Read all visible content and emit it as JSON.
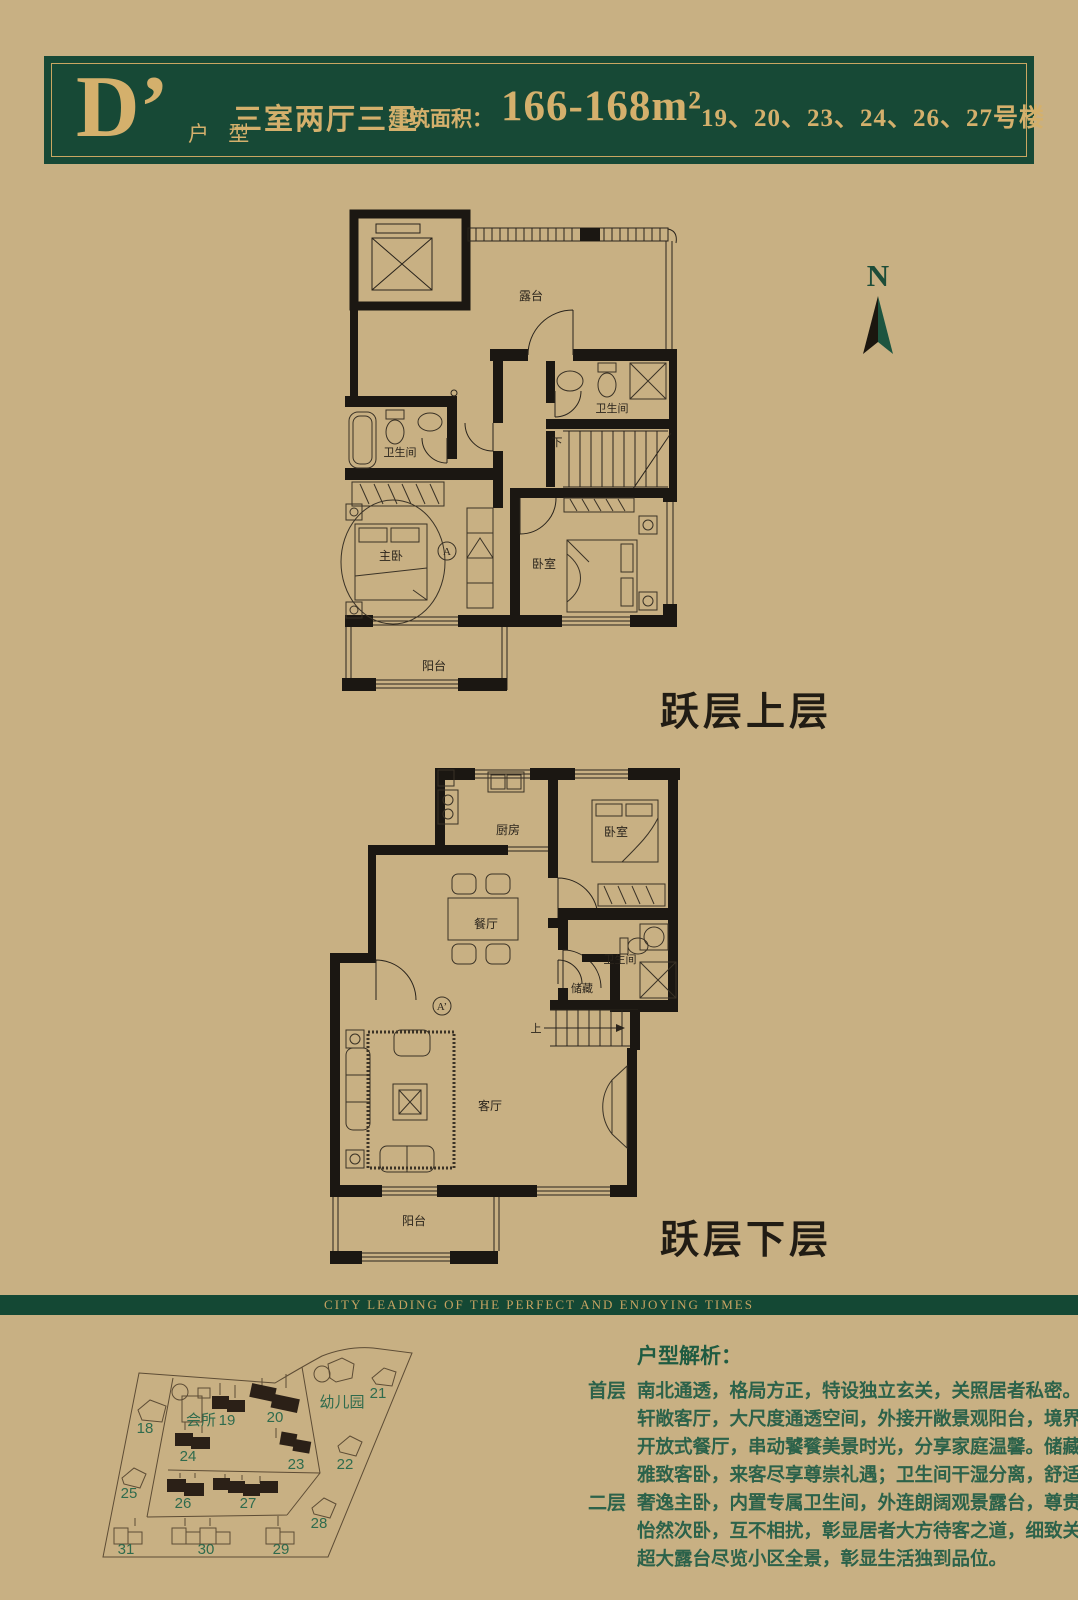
{
  "header": {
    "unit_letter": "D’",
    "unit_label": "户 型",
    "layout": "三室两厅三卫",
    "area_label": "建筑面积：",
    "area_value": "166-168m²",
    "buildings": "19、20、23、24、26、27号楼"
  },
  "compass": {
    "label": "N"
  },
  "plans": {
    "upper": {
      "caption": "跃层上层",
      "rooms": {
        "terrace": "露台",
        "bath1": "卫生间",
        "bath2": "卫生间",
        "master": "主卧",
        "bedroom": "卧室",
        "balcony": "阳台",
        "stairs_down": "下",
        "marker": "A"
      }
    },
    "lower": {
      "caption": "跃层下层",
      "rooms": {
        "kitchen": "厨房",
        "bedroom": "卧室",
        "dining": "餐厅",
        "bath": "卫生间",
        "storage": "储藏",
        "living": "客厅",
        "balcony": "阳台",
        "stairs_up": "上",
        "marker": "A’"
      }
    }
  },
  "band": {
    "slogan": "CITY LEADING OF THE PERFECT AND ENJOYING TIMES"
  },
  "sitemap": {
    "labels": {
      "b18": "18",
      "b19": "19",
      "b20": "20",
      "b21": "21",
      "b22": "22",
      "b23": "23",
      "b24": "24",
      "b25": "25",
      "b26": "26",
      "b27": "27",
      "b28": "28",
      "b29": "29",
      "b30": "30",
      "b31": "31",
      "club": "会所",
      "kindergarten": "幼儿园"
    }
  },
  "analysis": {
    "title": "户型解析：",
    "sections": [
      {
        "label": "首层",
        "lines": [
          "南北通透，格局方正，特设独立玄关，关照居者私密。",
          "轩敞客厅，大尺度通透空间，外接开敞景观阳台，境界尽在视野间。",
          "开放式餐厅，串动饕餮美景时光，分享家庭温馨。储藏间收纳生活点滴。",
          "雅致客卧，来客尽享尊崇礼遇；卫生间干湿分离，舒适生活起居。"
        ]
      },
      {
        "label": "二层",
        "lines": [
          "奢逸主卧，内置专属卫生间，外连朗阔观景露台，尊贵感浸润其中。",
          "怡然次卧，互不相扰，彰显居者大方待客之道，细致关怀。",
          "超大露台尽览小区全景，彰显生活独到品位。"
        ]
      }
    ]
  }
}
